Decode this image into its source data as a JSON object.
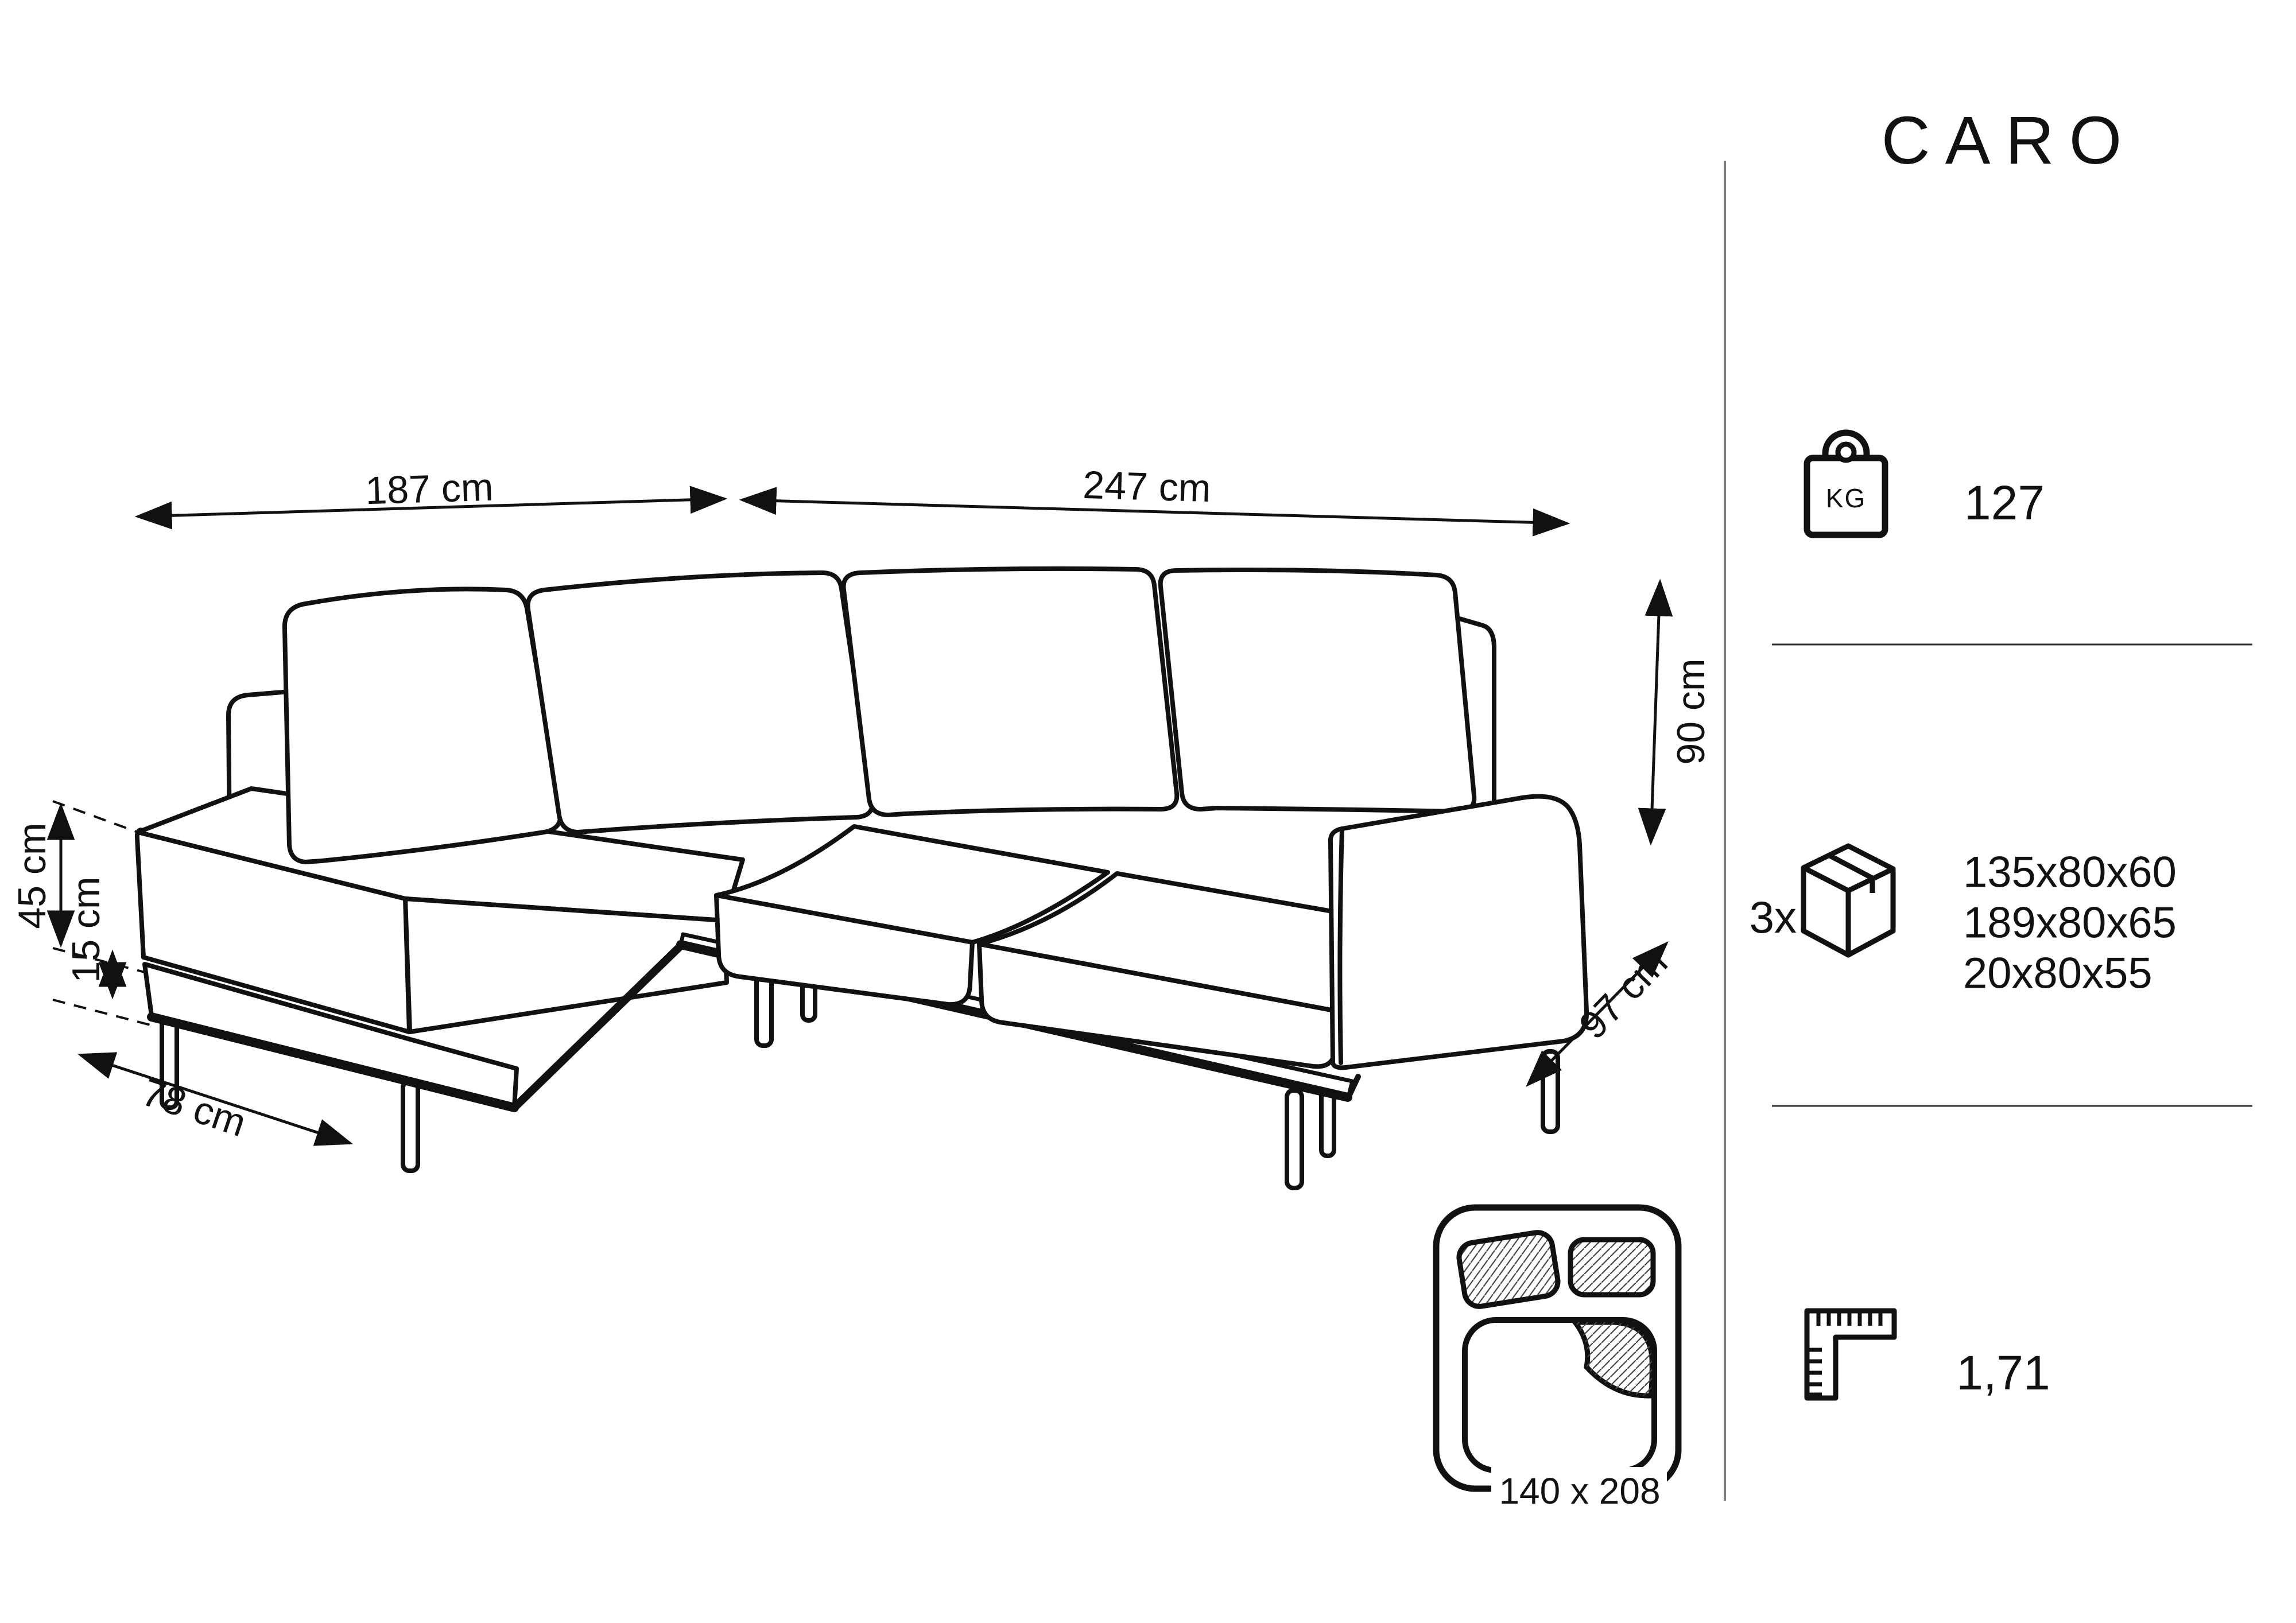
{
  "title": "CARO",
  "colors": {
    "line": "#111111",
    "divider_vertical": "#7d7d7d",
    "divider_horizontal": "#2f2f2f",
    "background": "#ffffff"
  },
  "sofa_dimensions": {
    "back_width_left": "187 cm",
    "back_width_right": "247 cm",
    "height": "90 cm",
    "depth": "97 cm",
    "chaise_width": "78 cm",
    "seat_height": "45 cm",
    "leg_height": "15 cm"
  },
  "sleeping_area": {
    "label": "140 x 208"
  },
  "specs": {
    "weight": {
      "icon": "kg-weight-icon",
      "unit_label": "KG",
      "value": "127"
    },
    "packaging": {
      "icon": "package-box-icon",
      "quantity": "3x",
      "box_sizes": [
        "135x80x60",
        "189x80x65",
        "20x80x55"
      ]
    },
    "volume": {
      "icon": "ruler-square-icon",
      "value": "1,71"
    }
  }
}
